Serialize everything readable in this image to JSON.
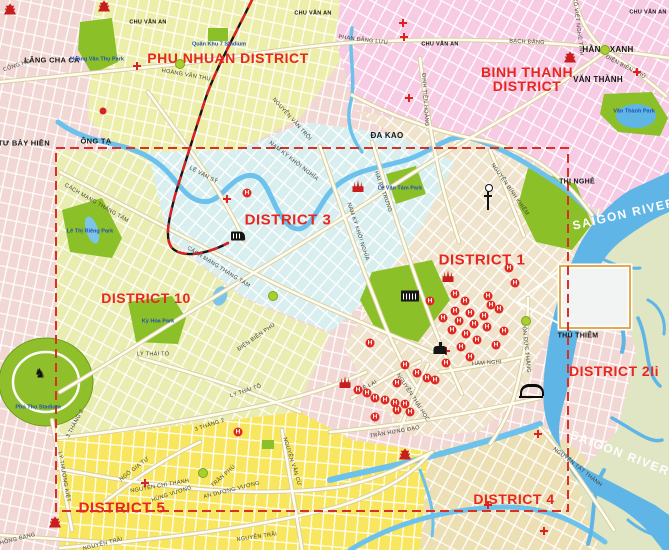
{
  "canvas": {
    "width": 669,
    "height": 550
  },
  "colors": {
    "district_label": "#e8261f",
    "boundary_dashed": "#d93025",
    "river": "#5fb6e6",
    "park_green": "#8cc028",
    "phu_nhuan_fill": "#edeeaa",
    "binh_thanh_fill": "#f6cbe3",
    "district3_fill": "#d9efef",
    "district1_fill": "#efe4cb",
    "district10_fill": "#eaedb2",
    "district5_fill": "#f8e65e",
    "district4_fill": "#ecdfb4",
    "district2_fill": "#e0e5c4"
  },
  "districts": [
    {
      "text": "PHU NHUAN DISTRICT",
      "x": 228,
      "y": 58,
      "size": 14,
      "rot": 0
    },
    {
      "text": "BINH THANH",
      "x": 527,
      "y": 72,
      "size": 14,
      "rot": 0
    },
    {
      "text": "DISTRICT",
      "x": 527,
      "y": 86,
      "size": 14,
      "rot": 0
    },
    {
      "text": "DISTRICT 3",
      "x": 288,
      "y": 220,
      "size": 15,
      "rot": 0
    },
    {
      "text": "DISTRICT 1",
      "x": 482,
      "y": 260,
      "size": 15,
      "rot": 0
    },
    {
      "text": "DISTRICT 10",
      "x": 146,
      "y": 298,
      "size": 14,
      "rot": 0
    },
    {
      "text": "DISTRICT 5",
      "x": 122,
      "y": 508,
      "size": 15,
      "rot": 0
    },
    {
      "text": "DISTRICT 4",
      "x": 514,
      "y": 499,
      "size": 14,
      "rot": 0
    },
    {
      "text": "DISTRICT 2Ii",
      "x": 614,
      "y": 371,
      "size": 14,
      "rot": 0
    }
  ],
  "rivers": [
    {
      "text": "SAIGON RIVER",
      "x": 624,
      "y": 214,
      "rot": -13
    },
    {
      "text": "SAIGON RIVER",
      "x": 620,
      "y": 453,
      "rot": 21
    }
  ],
  "places": [
    {
      "text": "LĂNG CHA CẢ",
      "x": 52,
      "y": 60,
      "size": 7.5
    },
    {
      "text": "ÔNG TẠ",
      "x": 96,
      "y": 141,
      "size": 7.5
    },
    {
      "text": "NGÃ TƯ BẢY HIỀN",
      "x": 14,
      "y": 143,
      "size": 7.5
    },
    {
      "text": "CHU VĂN AN",
      "x": 148,
      "y": 23,
      "size": 5.5
    },
    {
      "text": "CHU VĂN AN",
      "x": 313,
      "y": 14,
      "size": 5.5
    },
    {
      "text": "CHU VĂN AN",
      "x": 440,
      "y": 45,
      "size": 5.5
    },
    {
      "text": "CHU VĂN AN",
      "x": 648,
      "y": 13,
      "size": 5.5
    },
    {
      "text": "HÀNG XANH",
      "x": 608,
      "y": 50,
      "size": 8
    },
    {
      "text": "VĂN THÀNH",
      "x": 598,
      "y": 80,
      "size": 8
    },
    {
      "text": "ĐA KAO",
      "x": 387,
      "y": 136,
      "size": 8
    },
    {
      "text": "THỊ NGHÈ",
      "x": 577,
      "y": 182,
      "size": 7
    },
    {
      "text": "THỦ THIÊM",
      "x": 578,
      "y": 336,
      "size": 7
    }
  ],
  "roads": [
    {
      "text": "CỘNG HÒA",
      "x": 19,
      "y": 66,
      "rot": -18
    },
    {
      "text": "HOÀNG VĂN THỤ",
      "x": 186,
      "y": 76,
      "rot": 10
    },
    {
      "text": "NGUYỄN VĂN TRỖI",
      "x": 291,
      "y": 120,
      "rot": 48
    },
    {
      "text": "PHAN ĐĂNG LƯU",
      "x": 363,
      "y": 41,
      "rot": 7
    },
    {
      "text": "BẠCH ĐẰNG",
      "x": 527,
      "y": 43,
      "rot": 3
    },
    {
      "text": "XÔ VIẾT NGHỆ TĨNH",
      "x": 577,
      "y": 27,
      "rot": 83
    },
    {
      "text": "ĐIỆN BIÊN PHỦ",
      "x": 625,
      "y": 68,
      "rot": 28
    },
    {
      "text": "ĐINH TIÊN HOÀNG",
      "x": 424,
      "y": 100,
      "rot": 86
    },
    {
      "text": "LÊ VĂN SỸ",
      "x": 203,
      "y": 176,
      "rot": 28
    },
    {
      "text": "NAM KỲ KHỞI NGHĨA",
      "x": 293,
      "y": 162,
      "rot": 38
    },
    {
      "text": "NAM KỲ KHỞI NGHĨA",
      "x": 357,
      "y": 232,
      "rot": 72
    },
    {
      "text": "CÁCH MẠNG THÁNG TÁM",
      "x": 96,
      "y": 204,
      "rot": 30
    },
    {
      "text": "CÁCH MẠNG THÁNG TÁM",
      "x": 218,
      "y": 268,
      "rot": 32
    },
    {
      "text": "HAI BÀ TRƯNG",
      "x": 382,
      "y": 192,
      "rot": 70
    },
    {
      "text": "NGUYỄN BỈNH KHIÊM",
      "x": 509,
      "y": 190,
      "rot": 55
    },
    {
      "text": "ĐIỆN BIÊN PHỦ",
      "x": 257,
      "y": 338,
      "rot": -35
    },
    {
      "text": "LÝ THÁI TỔ",
      "x": 153,
      "y": 355,
      "rot": 0
    },
    {
      "text": "LÝ THÁI TỔ",
      "x": 246,
      "y": 392,
      "rot": -18
    },
    {
      "text": "3 THÁNG 2",
      "x": 76,
      "y": 424,
      "rot": -62
    },
    {
      "text": "3 THÁNG 2",
      "x": 210,
      "y": 426,
      "rot": -18
    },
    {
      "text": "LÝ THƯỜNG KIỆT",
      "x": 63,
      "y": 477,
      "rot": 80
    },
    {
      "text": "NGÔ GIA TỰ",
      "x": 135,
      "y": 470,
      "rot": -38
    },
    {
      "text": "NGUYỄN CHÍ THANH",
      "x": 160,
      "y": 487,
      "rot": -10
    },
    {
      "text": "HÙNG VƯƠNG",
      "x": 172,
      "y": 495,
      "rot": -18
    },
    {
      "text": "AN DƯƠNG VƯƠNG",
      "x": 232,
      "y": 491,
      "rot": -14
    },
    {
      "text": "TRẦN PHÚ",
      "x": 224,
      "y": 477,
      "rot": -42
    },
    {
      "text": "NGUYỄN TRÃI",
      "x": 103,
      "y": 545,
      "rot": -14
    },
    {
      "text": "NGUYỄN TRÃI",
      "x": 257,
      "y": 538,
      "rot": -8
    },
    {
      "text": "HỒNG BÀNG",
      "x": 18,
      "y": 540,
      "rot": -14
    },
    {
      "text": "NGUYỄN VĂN CỪ",
      "x": 291,
      "y": 462,
      "rot": 73
    },
    {
      "text": "TRẦN HƯNG ĐẠO",
      "x": 395,
      "y": 433,
      "rot": -10
    },
    {
      "text": "NGUYỄN THÁI HỌC",
      "x": 412,
      "y": 398,
      "rot": 57
    },
    {
      "text": "LÊ LAI",
      "x": 369,
      "y": 387,
      "rot": -28
    },
    {
      "text": "HÀM NGHI",
      "x": 487,
      "y": 364,
      "rot": -4
    },
    {
      "text": "TÔN ĐỨC THẮNG",
      "x": 525,
      "y": 348,
      "rot": 84
    },
    {
      "text": "NGUYỄN TẤT THÀNH",
      "x": 577,
      "y": 468,
      "rot": 38
    }
  ],
  "parks": [
    {
      "text": "Hoàng Văn Thụ Park",
      "x": 97,
      "y": 60
    },
    {
      "text": "Quân Khu 7 Stadium",
      "x": 219,
      "y": 45
    },
    {
      "text": "Lê Thị Riêng Park",
      "x": 90,
      "y": 232
    },
    {
      "text": "Kỳ Hòa Park",
      "x": 158,
      "y": 322
    },
    {
      "text": "Lê Văn Tám Park",
      "x": 400,
      "y": 189
    },
    {
      "text": "Văn Thành Park",
      "x": 634,
      "y": 112
    },
    {
      "text": "Phú Thọ Stadium",
      "x": 38,
      "y": 408
    }
  ],
  "icons": {
    "hotels": [
      [
        370,
        343
      ],
      [
        405,
        365
      ],
      [
        417,
        373
      ],
      [
        397,
        383
      ],
      [
        427,
        378
      ],
      [
        435,
        380
      ],
      [
        358,
        390
      ],
      [
        367,
        393
      ],
      [
        375,
        398
      ],
      [
        385,
        400
      ],
      [
        395,
        403
      ],
      [
        405,
        404
      ],
      [
        397,
        410
      ],
      [
        410,
        412
      ],
      [
        375,
        417
      ],
      [
        455,
        294
      ],
      [
        488,
        296
      ],
      [
        465,
        301
      ],
      [
        491,
        305
      ],
      [
        499,
        309
      ],
      [
        455,
        311
      ],
      [
        470,
        313
      ],
      [
        484,
        316
      ],
      [
        443,
        318
      ],
      [
        459,
        321
      ],
      [
        474,
        324
      ],
      [
        487,
        327
      ],
      [
        452,
        330
      ],
      [
        466,
        334
      ],
      [
        504,
        331
      ],
      [
        477,
        340
      ],
      [
        496,
        345
      ],
      [
        461,
        347
      ],
      [
        470,
        357
      ],
      [
        446,
        363
      ],
      [
        430,
        301
      ],
      [
        509,
        268
      ],
      [
        515,
        283
      ],
      [
        247,
        193
      ],
      [
        238,
        432
      ]
    ],
    "hospitals": [
      [
        137,
        66
      ],
      [
        403,
        23
      ],
      [
        404,
        37
      ],
      [
        409,
        98
      ],
      [
        227,
        199
      ],
      [
        446,
        351
      ],
      [
        145,
        483
      ],
      [
        488,
        505
      ],
      [
        544,
        531
      ],
      [
        637,
        72
      ],
      [
        538,
        434
      ]
    ],
    "churches": [
      [
        448,
        276
      ],
      [
        358,
        186
      ],
      [
        345,
        382
      ]
    ],
    "pagodas": [
      [
        570,
        57
      ],
      [
        55,
        522
      ],
      [
        405,
        454
      ],
      [
        10,
        9
      ],
      [
        104,
        6
      ]
    ],
    "roundabouts": [
      [
        180,
        64
      ],
      [
        605,
        50
      ],
      [
        273,
        296
      ],
      [
        526,
        321
      ],
      [
        203,
        473
      ]
    ],
    "landmarks": [
      {
        "type": "railway-station",
        "x": 238,
        "y": 236
      },
      {
        "type": "palace",
        "x": 410,
        "y": 296
      },
      {
        "type": "market",
        "x": 440,
        "y": 350
      },
      {
        "type": "tv-tower",
        "x": 488,
        "y": 198
      },
      {
        "type": "bridge",
        "x": 532,
        "y": 390
      },
      {
        "type": "horse",
        "x": 40,
        "y": 374,
        "glyph": "♞"
      },
      {
        "type": "poi-dot",
        "x": 103,
        "y": 111
      }
    ]
  }
}
